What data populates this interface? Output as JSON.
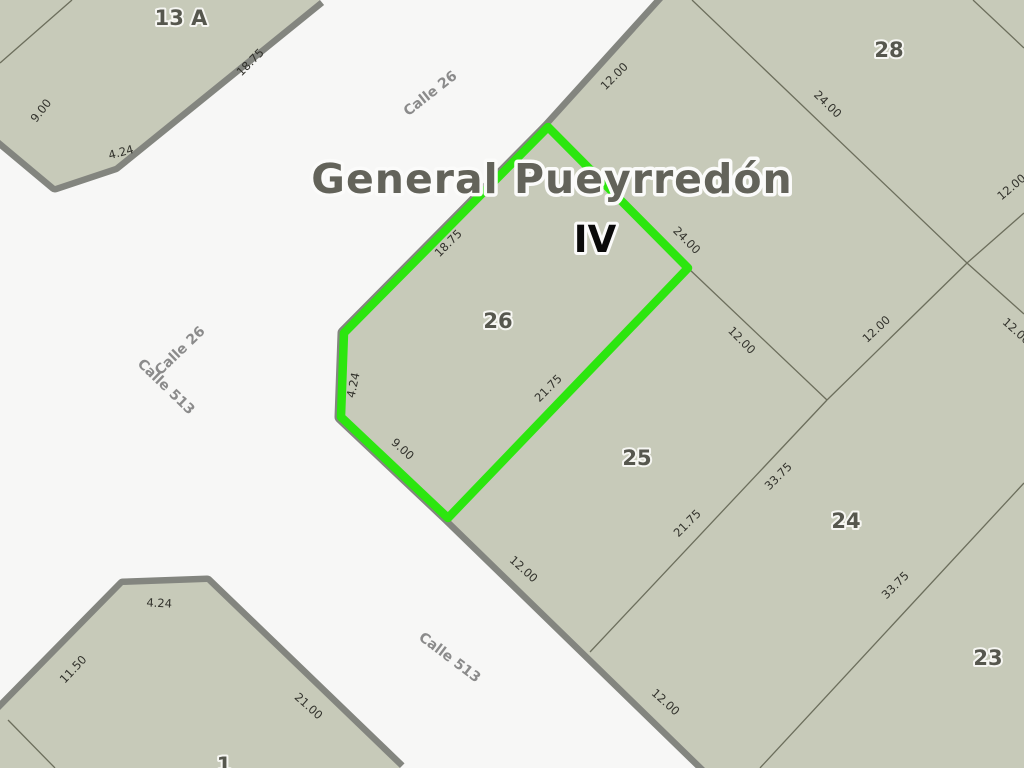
{
  "map": {
    "title": "General Pueyrredón",
    "section_label": "IV",
    "highlighted_parcel": "26"
  },
  "colors": {
    "street_bg": "#f7f7f6",
    "parcel_fill": "#c7cab9",
    "street_border": "#83857f",
    "boundary_line": "#6c6e5c",
    "highlight_green": "#2ce60f",
    "title_color": "#63635a",
    "iv_color": "#0a0a0a",
    "parcel_num_color": "#56574e",
    "street_name_color": "#8b8b8b",
    "measure_color": "#32322c"
  },
  "streets": [
    {
      "label": "Calle 26",
      "x": 433,
      "y": 97,
      "rot": -38
    },
    {
      "label": "Calle 26",
      "x": 183,
      "y": 354,
      "rot": -44
    },
    {
      "label": "Calle 513",
      "x": 163,
      "y": 390,
      "rot": 44
    },
    {
      "label": "Calle 513",
      "x": 447,
      "y": 661,
      "rot": 37
    }
  ],
  "parcels": [
    {
      "number": "13 A",
      "x": 181,
      "y": 25
    },
    {
      "number": "28",
      "x": 889,
      "y": 57
    },
    {
      "number": "26",
      "x": 498,
      "y": 328
    },
    {
      "number": "25",
      "x": 637,
      "y": 465
    },
    {
      "number": "24",
      "x": 846,
      "y": 528
    },
    {
      "number": "23",
      "x": 988,
      "y": 665
    },
    {
      "number": "1",
      "x": 224,
      "y": 772
    }
  ],
  "measurements": [
    {
      "value": "18.75",
      "x": 253,
      "y": 65,
      "rot": -45
    },
    {
      "value": "9.00",
      "x": 44,
      "y": 113,
      "rot": -52
    },
    {
      "value": "4.24",
      "x": 122,
      "y": 156,
      "rot": -15
    },
    {
      "value": "12.00",
      "x": 617,
      "y": 79,
      "rot": -45
    },
    {
      "value": "24.00",
      "x": 825,
      "y": 107,
      "rot": 44
    },
    {
      "value": "12.00",
      "x": 1014,
      "y": 190,
      "rot": -40
    },
    {
      "value": "18.75",
      "x": 451,
      "y": 246,
      "rot": -45
    },
    {
      "value": "4.24",
      "x": 357,
      "y": 386,
      "rot": -78
    },
    {
      "value": "9.00",
      "x": 400,
      "y": 452,
      "rot": 42
    },
    {
      "value": "21.75",
      "x": 551,
      "y": 391,
      "rot": -45
    },
    {
      "value": "24.00",
      "x": 684,
      "y": 243,
      "rot": 45
    },
    {
      "value": "12.00",
      "x": 739,
      "y": 343,
      "rot": 45
    },
    {
      "value": "12.00",
      "x": 879,
      "y": 332,
      "rot": -43
    },
    {
      "value": "12.00",
      "x": 1014,
      "y": 334,
      "rot": 42
    },
    {
      "value": "12.00",
      "x": 521,
      "y": 572,
      "rot": 42
    },
    {
      "value": "21.75",
      "x": 690,
      "y": 526,
      "rot": -45
    },
    {
      "value": "33.75",
      "x": 781,
      "y": 479,
      "rot": -45
    },
    {
      "value": "33.75",
      "x": 898,
      "y": 588,
      "rot": -45
    },
    {
      "value": "12.00",
      "x": 663,
      "y": 705,
      "rot": 42
    },
    {
      "value": "4.24",
      "x": 159,
      "y": 607,
      "rot": 3
    },
    {
      "value": "11.50",
      "x": 76,
      "y": 672,
      "rot": -47
    },
    {
      "value": "21.00",
      "x": 306,
      "y": 709,
      "rot": 42
    }
  ]
}
